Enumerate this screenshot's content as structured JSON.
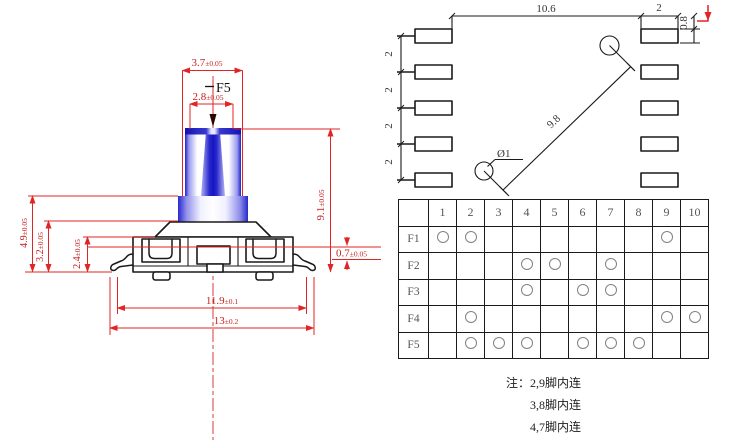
{
  "colors": {
    "dimension_red": "#e02525",
    "line_black": "#1a1a1a",
    "stem_blue_dark": "#1c1cc8",
    "stem_blue_light": "#9a9aee",
    "table_text": "#555555"
  },
  "side_view": {
    "dims": {
      "cap_width": {
        "value": "3.7",
        "tol": "±0.05"
      },
      "stem_width": {
        "value": "2.8",
        "tol": "±0.05"
      },
      "actuator_label": "F5",
      "total_height": {
        "value": "4.9",
        "tol": "±0.05"
      },
      "mid_height": {
        "value": "3.2",
        "tol": "±0.05"
      },
      "body_height": {
        "value": "2.4",
        "tol": "±0.05"
      },
      "stem_height": {
        "value": "9.1",
        "tol": "±0.05"
      },
      "standoff": {
        "value": "0.7",
        "tol": "±0.05"
      },
      "body_width": {
        "value": "11.9",
        "tol": "±0.1"
      },
      "lead_span": {
        "value": "13",
        "tol": "±0.2"
      }
    }
  },
  "footprint": {
    "dims": {
      "pad_gap": {
        "value": "10.6",
        "tol": ""
      },
      "pad_width": {
        "value": "2",
        "tol": ""
      },
      "pad_height": {
        "value": "0.8",
        "tol": ""
      },
      "pitch": "2",
      "hole_distance": {
        "value": "9.8",
        "tol": ""
      },
      "hole_diameter": {
        "value": "Ø1",
        "tol": ""
      }
    }
  },
  "pin_table": {
    "corner": "",
    "columns": [
      "1",
      "2",
      "3",
      "4",
      "5",
      "6",
      "7",
      "8",
      "9",
      "10"
    ],
    "rows": [
      {
        "label": "F1",
        "pins": [
          "1",
          "2",
          "9"
        ]
      },
      {
        "label": "F2",
        "pins": [
          "4",
          "5",
          "7"
        ]
      },
      {
        "label": "F3",
        "pins": [
          "4",
          "6",
          "7"
        ]
      },
      {
        "label": "F4",
        "pins": [
          "2",
          "9",
          "10"
        ]
      },
      {
        "label": "F5",
        "pins": [
          "2",
          "3",
          "4",
          "6",
          "7",
          "8"
        ]
      }
    ]
  },
  "notes": {
    "prefix": "注：",
    "lines": [
      "2,9脚内连",
      "3,8脚内连",
      "4,7脚内连"
    ]
  }
}
